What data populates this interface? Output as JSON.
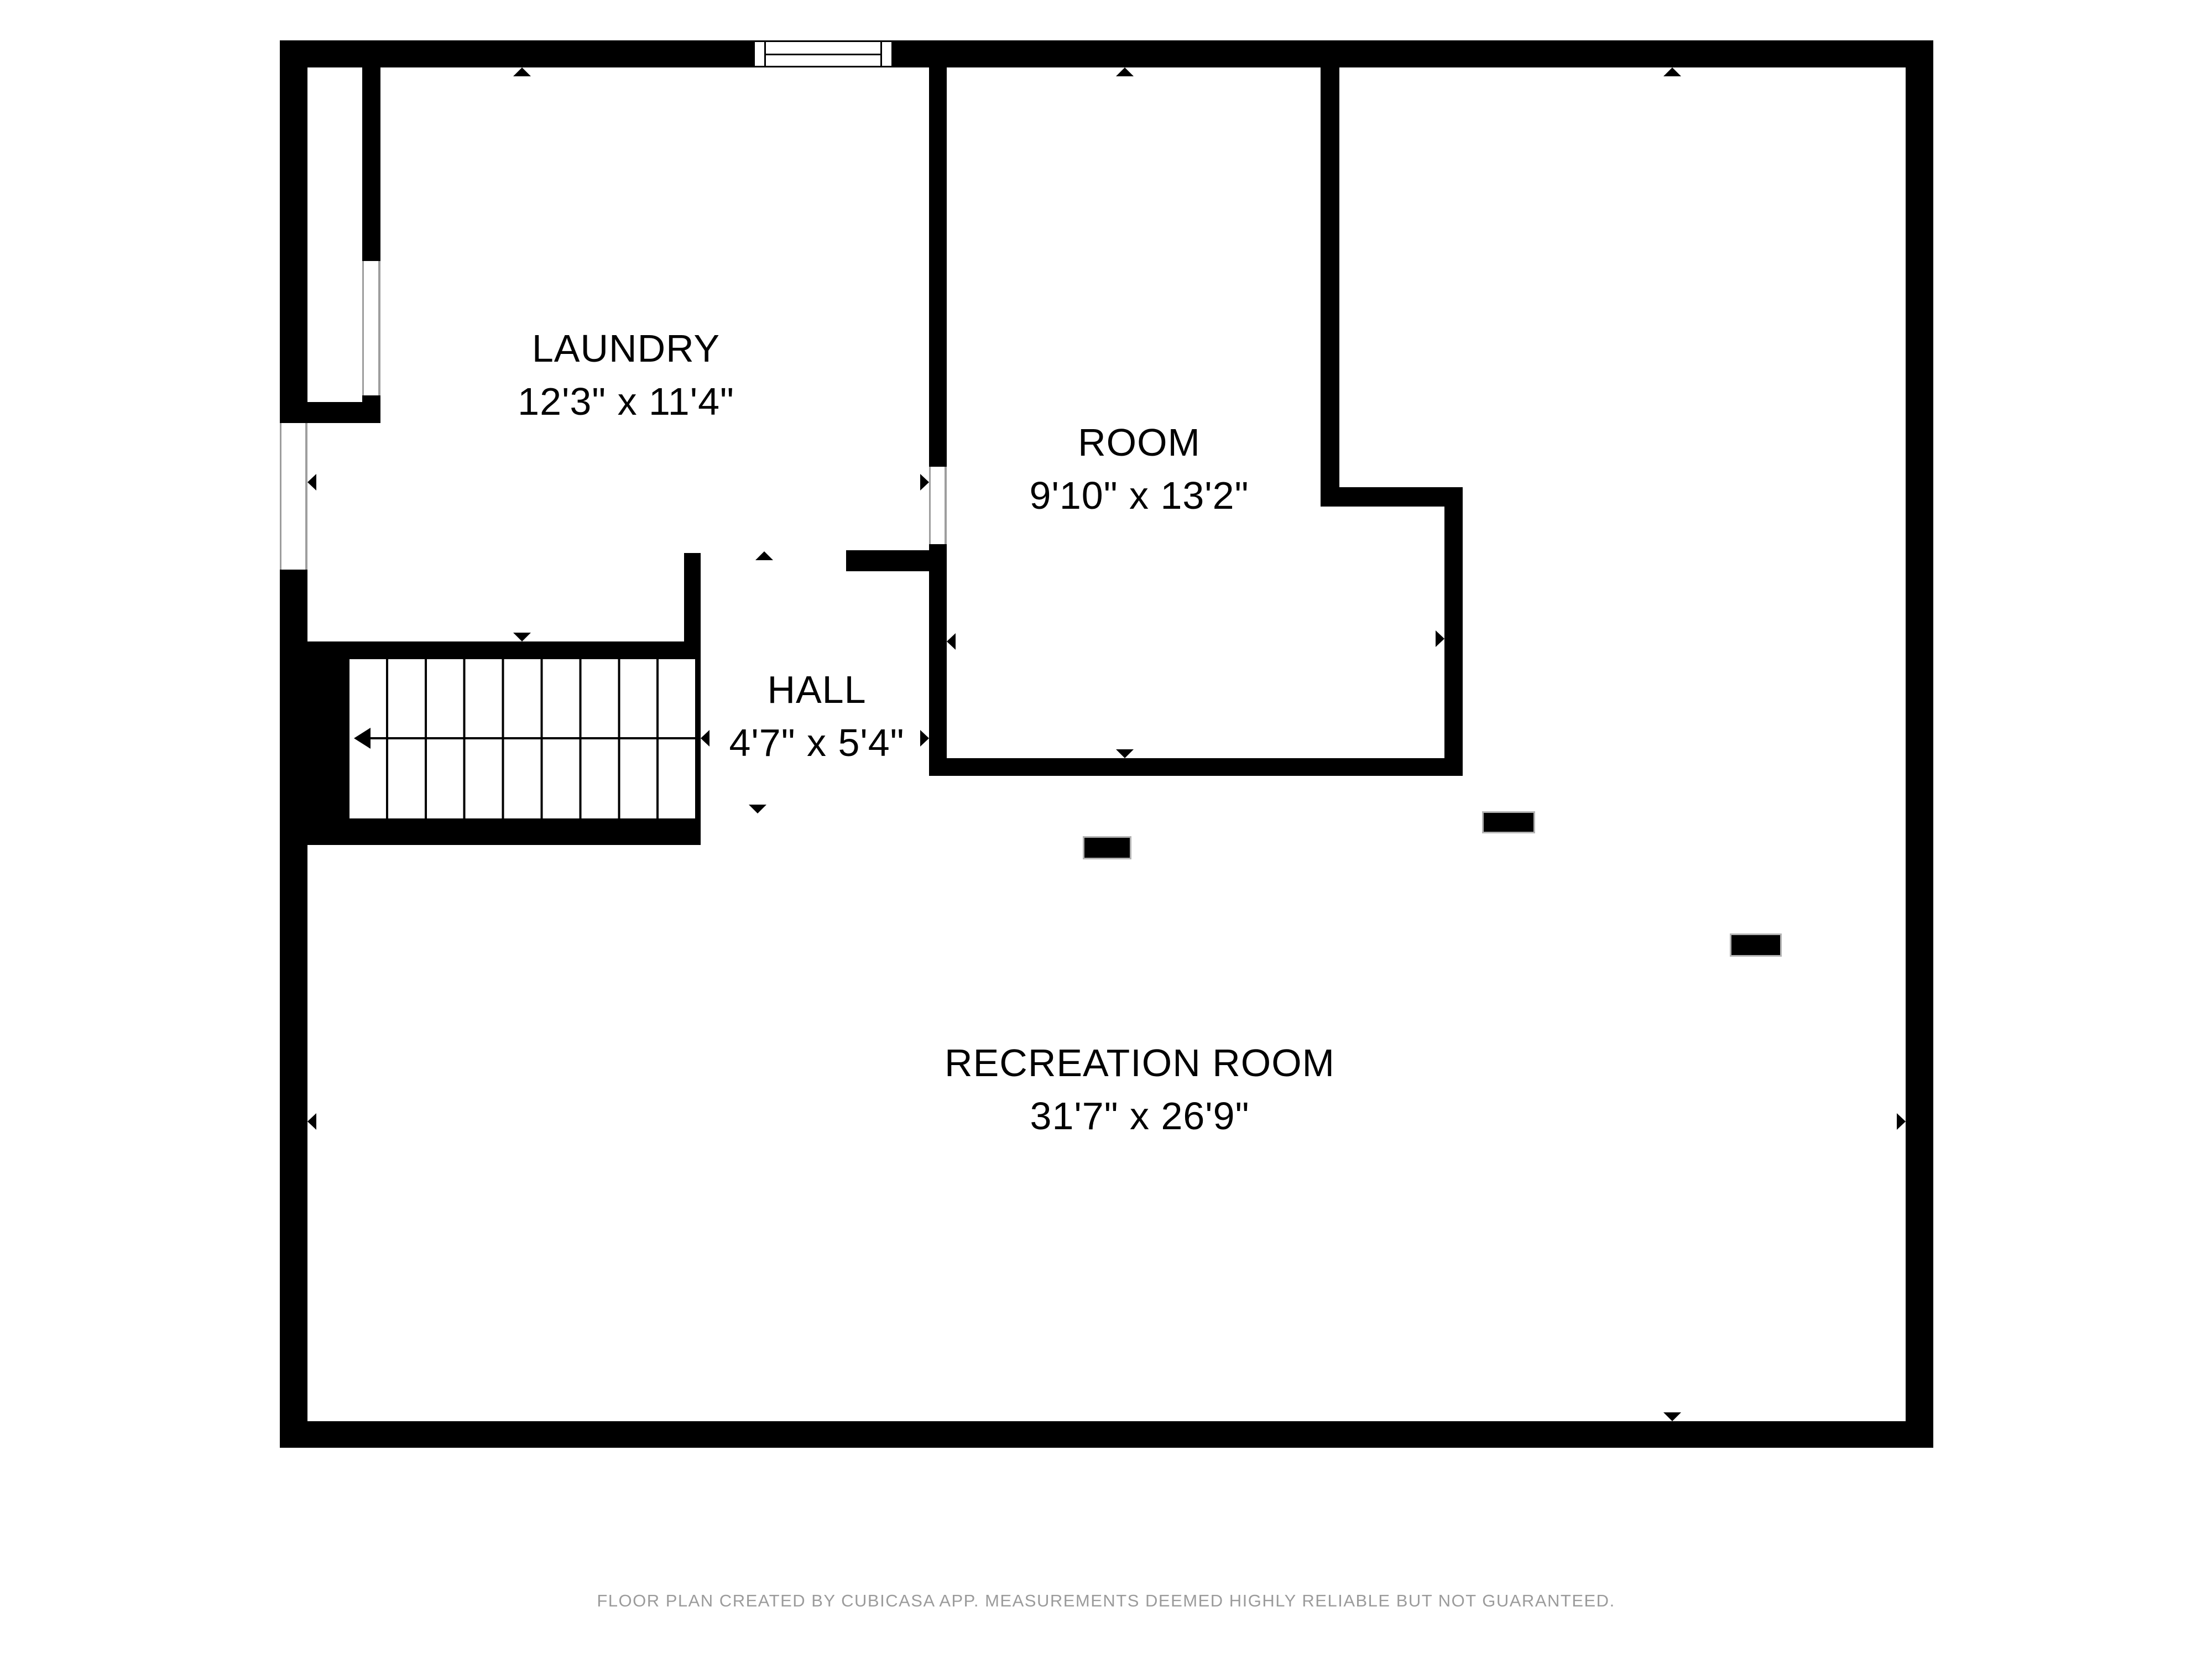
{
  "rooms": [
    {
      "name": "LAUNDRY",
      "dims": "12'3\" x 11'4\""
    },
    {
      "name": "ROOM",
      "dims": "9'10\" x 13'2\""
    },
    {
      "name": "HALL",
      "dims": "4'7\" x 5'4\""
    },
    {
      "name": "RECREATION ROOM",
      "dims": "31'7\" x 26'9\""
    }
  ],
  "footer": "FLOOR PLAN CREATED BY CUBICASA APP. MEASUREMENTS DEEMED HIGHLY RELIABLE BUT NOT GUARANTEED.",
  "icons": {
    "window-icon": "rectangle with jambs and center line",
    "stairs-icon": "parallel treads with direction arrow",
    "opening-marker-icon": "small solid triangle"
  },
  "colors": {
    "wall": "#000000",
    "background": "#ffffff",
    "label_text": "#000000",
    "footer_text": "#9b9b9b",
    "jamb_line": "#9e9e9e"
  }
}
